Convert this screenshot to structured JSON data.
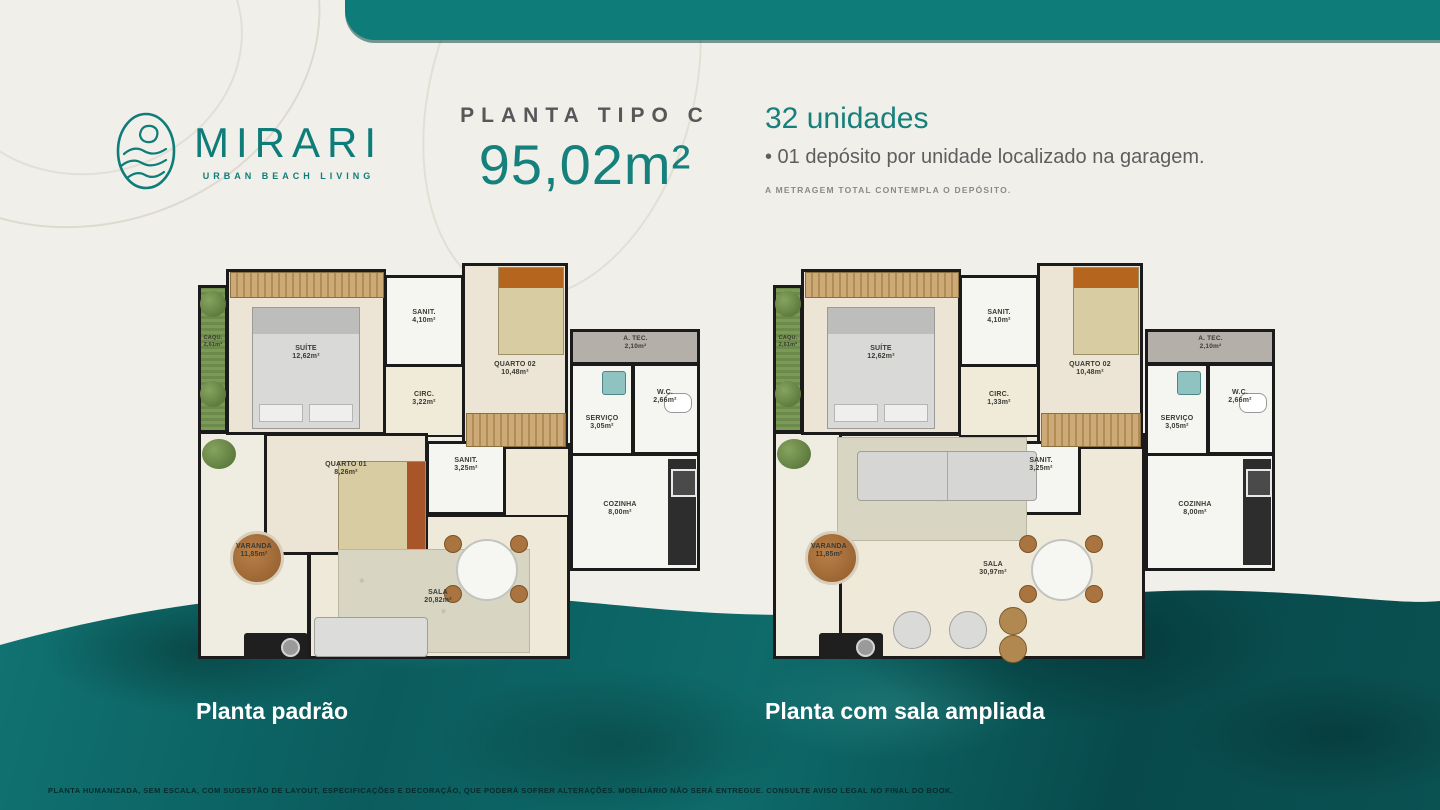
{
  "colors": {
    "accent_teal": "#0e7c79",
    "water_teal": "#0a5f60",
    "background_cream": "#f1efe9",
    "wall_black": "#1b1b1b"
  },
  "brand": {
    "name": "MIRARI",
    "tagline": "URBAN BEACH LIVING"
  },
  "header": {
    "plan_type": "PLANTA TIPO C",
    "area": "95,02m²",
    "units": "32 unidades",
    "detail": "• 01 depósito por unidade localizado na garagem.",
    "note": "A METRAGEM TOTAL CONTEMPLA O DEPÓSITO."
  },
  "plans": [
    {
      "caption": "Planta padrão",
      "rooms": {
        "caqu": {
          "label": "CAQU.",
          "area": "2,61m²"
        },
        "suite": {
          "label": "SUÍTE",
          "area": "12,62m²"
        },
        "sanit": {
          "label": "SANIT.",
          "area": "4,10m²"
        },
        "quarto02": {
          "label": "QUARTO 02",
          "area": "10,48m²"
        },
        "atec": {
          "label": "A. TEC.",
          "area": "2,10m²"
        },
        "wc": {
          "label": "W.C.",
          "area": "2,66m²"
        },
        "servico": {
          "label": "SERVIÇO",
          "area": "3,05m²"
        },
        "circ": {
          "label": "CIRC.",
          "area": "3,22m²"
        },
        "quarto01": {
          "label": "QUARTO 01",
          "area": "8,26m²"
        },
        "sanit2": {
          "label": "SANIT.",
          "area": "3,25m²"
        },
        "varanda": {
          "label": "VARANDA",
          "area": "11,85m²"
        },
        "sala": {
          "label": "SALA",
          "area": "20,82m²"
        },
        "cozinha": {
          "label": "COZINHA",
          "area": "8,00m²"
        }
      }
    },
    {
      "caption": "Planta com sala ampliada",
      "rooms": {
        "caqu": {
          "label": "CAQU.",
          "area": "2,61m²"
        },
        "suite": {
          "label": "SUÍTE",
          "area": "12,62m²"
        },
        "sanit": {
          "label": "SANIT.",
          "area": "4,10m²"
        },
        "quarto02": {
          "label": "QUARTO 02",
          "area": "10,48m²"
        },
        "atec": {
          "label": "A. TEC.",
          "area": "2,10m²"
        },
        "wc": {
          "label": "W.C.",
          "area": "2,66m²"
        },
        "servico": {
          "label": "SERVIÇO",
          "area": "3,05m²"
        },
        "circ": {
          "label": "CIRC.",
          "area": "1,33m²"
        },
        "sanit2": {
          "label": "SANIT.",
          "area": "3,25m²"
        },
        "varanda": {
          "label": "VARANDA",
          "area": "11,85m²"
        },
        "sala": {
          "label": "SALA",
          "area": "30,97m²"
        },
        "cozinha": {
          "label": "COZINHA",
          "area": "8,00m²"
        }
      }
    }
  ],
  "footer": {
    "disclaimer": "PLANTA HUMANIZADA, SEM ESCALA, COM SUGESTÃO DE LAYOUT, ESPECIFICAÇÕES E DECORAÇÃO, QUE PODERÁ SOFRER ALTERAÇÕES. MOBILIÁRIO NÃO SERÁ ENTREGUE. CONSULTE AVISO LEGAL NO FINAL DO BOOK."
  }
}
